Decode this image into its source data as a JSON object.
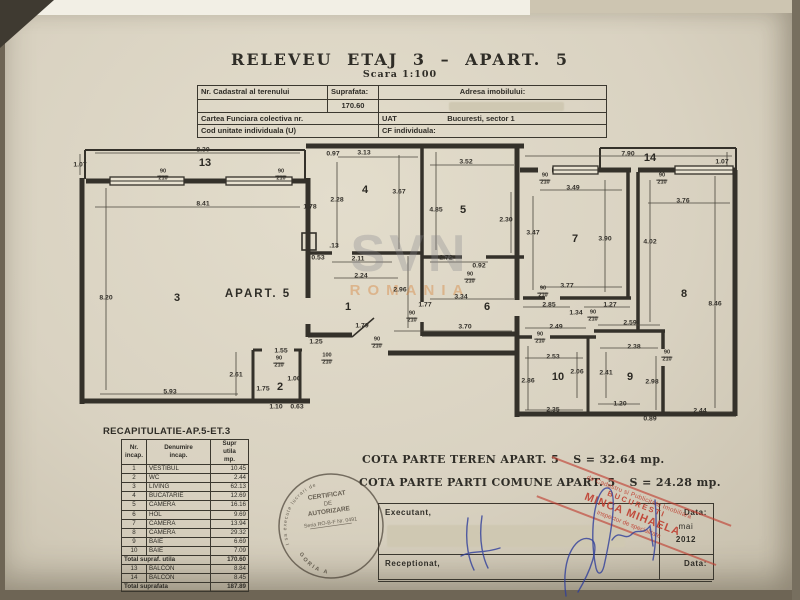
{
  "title": {
    "main": "RELEVEU  ETAJ  3  –  APART.  5",
    "scale": "Scara  1:100"
  },
  "header_table": {
    "nr_cadastral_label": "Nr. Cadastral al terenului",
    "suprafata_label": "Suprafata:",
    "suprafata_value": "170.60",
    "adresa_label": "Adresa imobilului:",
    "cartea_label": "Cartea Funciara colectiva nr.",
    "uat_label": "UAT",
    "uat_value": "Bucuresti, sector 1",
    "cod_label": "Cod unitate individuala (U)",
    "cf_label": "CF individuala:"
  },
  "floorplan": {
    "apart_label": "APART. 5",
    "apart_pos": {
      "x": 258,
      "y": 294
    },
    "rooms": [
      {
        "n": "13",
        "x": 205,
        "y": 163
      },
      {
        "n": "3",
        "x": 177,
        "y": 298
      },
      {
        "n": "4",
        "x": 365,
        "y": 190
      },
      {
        "n": "1",
        "x": 348,
        "y": 307
      },
      {
        "n": "2",
        "x": 280,
        "y": 387
      },
      {
        "n": "5",
        "x": 463,
        "y": 210
      },
      {
        "n": "6",
        "x": 487,
        "y": 307
      },
      {
        "n": "7",
        "x": 575,
        "y": 239
      },
      {
        "n": "14",
        "x": 650,
        "y": 158
      },
      {
        "n": "8",
        "x": 684,
        "y": 294
      },
      {
        "n": "10",
        "x": 558,
        "y": 377
      },
      {
        "n": "9",
        "x": 630,
        "y": 377
      }
    ],
    "dimensions": [
      {
        "t": "1.07",
        "x": 80,
        "y": 165
      },
      {
        "t": "8.30",
        "x": 203,
        "y": 150
      },
      {
        "t": "8.41",
        "x": 203,
        "y": 204
      },
      {
        "t": "8.20",
        "x": 106,
        "y": 298
      },
      {
        "t": "5.93",
        "x": 170,
        "y": 392
      },
      {
        "t": "2.61",
        "x": 236,
        "y": 375
      },
      {
        "t": "1.55",
        "x": 281,
        "y": 351
      },
      {
        "t": "1.00",
        "x": 294,
        "y": 379
      },
      {
        "t": "1.75",
        "x": 263,
        "y": 389
      },
      {
        "t": "1.10",
        "x": 276,
        "y": 407
      },
      {
        "t": "0.63",
        "x": 297,
        "y": 407
      },
      {
        "t": "0.97",
        "x": 333,
        "y": 154
      },
      {
        "t": "3.13",
        "x": 364,
        "y": 153
      },
      {
        "t": "2.28",
        "x": 337,
        "y": 200
      },
      {
        "t": "3.67",
        "x": 399,
        "y": 192
      },
      {
        "t": "1.78",
        "x": 310,
        "y": 207
      },
      {
        "t": ".13",
        "x": 334,
        "y": 246
      },
      {
        "t": "0.53",
        "x": 318,
        "y": 258
      },
      {
        "t": "2.11",
        "x": 358,
        "y": 259
      },
      {
        "t": "2.24",
        "x": 361,
        "y": 276
      },
      {
        "t": "2.96",
        "x": 400,
        "y": 290
      },
      {
        "t": "1.79",
        "x": 362,
        "y": 326
      },
      {
        "t": "1.25",
        "x": 316,
        "y": 342
      },
      {
        "t": "3.52",
        "x": 466,
        "y": 162
      },
      {
        "t": "4.85",
        "x": 436,
        "y": 210
      },
      {
        "t": "2.30",
        "x": 506,
        "y": 220
      },
      {
        "t": "2.72",
        "x": 446,
        "y": 258
      },
      {
        "t": "0.92",
        "x": 479,
        "y": 266
      },
      {
        "t": "3.34",
        "x": 461,
        "y": 297
      },
      {
        "t": "1.77",
        "x": 425,
        "y": 305
      },
      {
        "t": "3.70",
        "x": 465,
        "y": 327
      },
      {
        "t": "7.90",
        "x": 628,
        "y": 154
      },
      {
        "t": "1.07",
        "x": 722,
        "y": 162
      },
      {
        "t": "3.49",
        "x": 573,
        "y": 188
      },
      {
        "t": "3.47",
        "x": 533,
        "y": 233
      },
      {
        "t": "3.90",
        "x": 605,
        "y": 239
      },
      {
        "t": "4.02",
        "x": 650,
        "y": 242
      },
      {
        "t": "3.76",
        "x": 683,
        "y": 201
      },
      {
        "t": "8.46",
        "x": 715,
        "y": 304
      },
      {
        "t": "3.77",
        "x": 567,
        "y": 286
      },
      {
        "t": "2.85",
        "x": 549,
        "y": 305
      },
      {
        "t": "1.34",
        "x": 576,
        "y": 313
      },
      {
        "t": "1.27",
        "x": 610,
        "y": 305
      },
      {
        "t": "2.49",
        "x": 556,
        "y": 327
      },
      {
        "t": "2.59",
        "x": 630,
        "y": 323
      },
      {
        "t": "2.53",
        "x": 553,
        "y": 357
      },
      {
        "t": "2.38",
        "x": 634,
        "y": 347
      },
      {
        "t": "2.86",
        "x": 528,
        "y": 381
      },
      {
        "t": "2.06",
        "x": 577,
        "y": 372
      },
      {
        "t": "2.41",
        "x": 606,
        "y": 373
      },
      {
        "t": "2.98",
        "x": 652,
        "y": 382
      },
      {
        "t": "2.35",
        "x": 553,
        "y": 410
      },
      {
        "t": "1.20",
        "x": 620,
        "y": 404
      },
      {
        "t": "0.89",
        "x": 650,
        "y": 419
      },
      {
        "t": "2.44",
        "x": 700,
        "y": 411
      }
    ],
    "doors": [
      {
        "w": "90",
        "h": "210",
        "x": 163,
        "y": 176
      },
      {
        "w": "90",
        "h": "210",
        "x": 281,
        "y": 176
      },
      {
        "w": "90",
        "h": "210",
        "x": 279,
        "y": 363
      },
      {
        "w": "90",
        "h": "210",
        "x": 377,
        "y": 344
      },
      {
        "w": "100",
        "h": "210",
        "x": 327,
        "y": 360
      },
      {
        "w": "90",
        "h": "210",
        "x": 412,
        "y": 318
      },
      {
        "w": "90",
        "h": "210",
        "x": 470,
        "y": 279
      },
      {
        "w": "90",
        "h": "210",
        "x": 545,
        "y": 180
      },
      {
        "w": "90",
        "h": "210",
        "x": 662,
        "y": 180
      },
      {
        "w": "90",
        "h": "210",
        "x": 543,
        "y": 293
      },
      {
        "w": "90",
        "h": "210",
        "x": 593,
        "y": 317
      },
      {
        "w": "90",
        "h": "210",
        "x": 540,
        "y": 339
      },
      {
        "w": "90",
        "h": "210",
        "x": 667,
        "y": 357
      }
    ],
    "watermark": {
      "line1": "SVN",
      "line2": "ROMANIA"
    }
  },
  "recap_table": {
    "title": "RECAPITULATIE-AP.5-ET.3",
    "headers": [
      "Nr.\nincap.",
      "Denumire\nincap.",
      "Supr\nutila\nmp."
    ],
    "rows": [
      [
        "1",
        "VESTIBUL",
        "10.45"
      ],
      [
        "2",
        "WC",
        "2.44"
      ],
      [
        "3",
        "LIVING",
        "62.13"
      ],
      [
        "4",
        "BUCATARIE",
        "12.69"
      ],
      [
        "5",
        "CAMERA",
        "16.16"
      ],
      [
        "6",
        "HOL",
        "9.69"
      ],
      [
        "7",
        "CAMERA",
        "13.94"
      ],
      [
        "8",
        "CAMERA",
        "29.32"
      ],
      [
        "9",
        "BAIE",
        "6.69"
      ],
      [
        "10",
        "BAIE",
        "7.09"
      ]
    ],
    "total_utila": {
      "label": "Total supraf. utila",
      "value": "170.60"
    },
    "balcony_rows": [
      [
        "13",
        "BALCON",
        "8.84"
      ],
      [
        "14",
        "BALCON",
        "8.45"
      ]
    ],
    "total": {
      "label": "Total suprafata",
      "value": "187.89"
    }
  },
  "cota": {
    "teren_label": "COTA PARTE TEREN APART. 5",
    "teren_value": "S = 32.64 mp.",
    "comune_label": "COTA PARTE PARTI COMUNE APART. 5",
    "comune_value": "S = 24.28 mp."
  },
  "signature_box": {
    "executant": "Executant,",
    "receptionat": "Receptionat,",
    "data_label_1": "Data:",
    "data_month": "mai",
    "data_year": "2012",
    "data_label_2": "Data:"
  },
  "stamps": {
    "round": {
      "edge_top": "autorizat de ANCPI sa execute lucrari de",
      "line1": "CERTIFICAT",
      "line2": "DE",
      "line3": "AUTORIZARE",
      "line4": "Seria RO-B-F Nr. 0491",
      "edge_bottom": "CATEGORIA  A"
    },
    "red": {
      "line1": "de Cadastru si Publicitate Imobiliara",
      "line2": "BUCURESTI",
      "line3": "MINCA MIHAELA",
      "line4": "inspector de specialitate"
    }
  },
  "colors": {
    "paper": "#d9d2c1",
    "ink": "#2f2d27",
    "stamp_red": "#bf3b2d",
    "ink_blue": "#2f3f9b",
    "watermark_orange": "#d67a2b"
  }
}
